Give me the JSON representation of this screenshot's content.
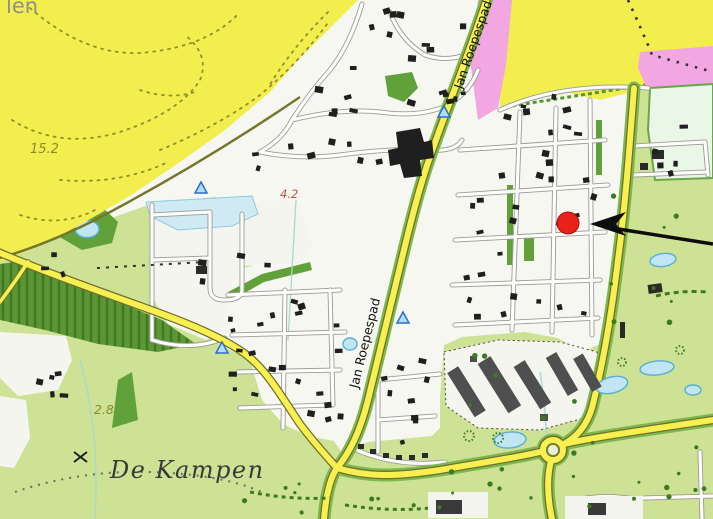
{
  "map": {
    "labels": {
      "partial_place": "len",
      "area": "De Kampen",
      "road": "Jan Roepespad",
      "height_1": "15.2",
      "height_2": "4.2",
      "height_3": "2.8"
    },
    "marker": {
      "shape": "circle",
      "color": "#e8211a"
    },
    "arrow": {
      "color": "#0d0d0d",
      "direction": "pointing-left-at-marker"
    },
    "colors": {
      "heath_yellow": "#f2ee4d",
      "field_green": "#cde294",
      "forest_green": "#61a139",
      "urban_pink": "#f2a6e2",
      "road_yellow": "#f8ef52",
      "road_casing": "#6f6f2f",
      "water_blue": "#bfe6f2",
      "water_edge": "#58aed2",
      "building_black": "#1f1f1f",
      "building_gray": "#4f4f4f",
      "pale_field": "#eaf6e6",
      "label_olive": "#8a8a2e",
      "label_red": "#b4574e",
      "label_gray": "#8f8f8f",
      "label_dark": "#3a3a3a"
    },
    "symbols": {
      "campsite_triangle": "triangle-icon",
      "survey_cross": "x-mark-icon"
    }
  }
}
